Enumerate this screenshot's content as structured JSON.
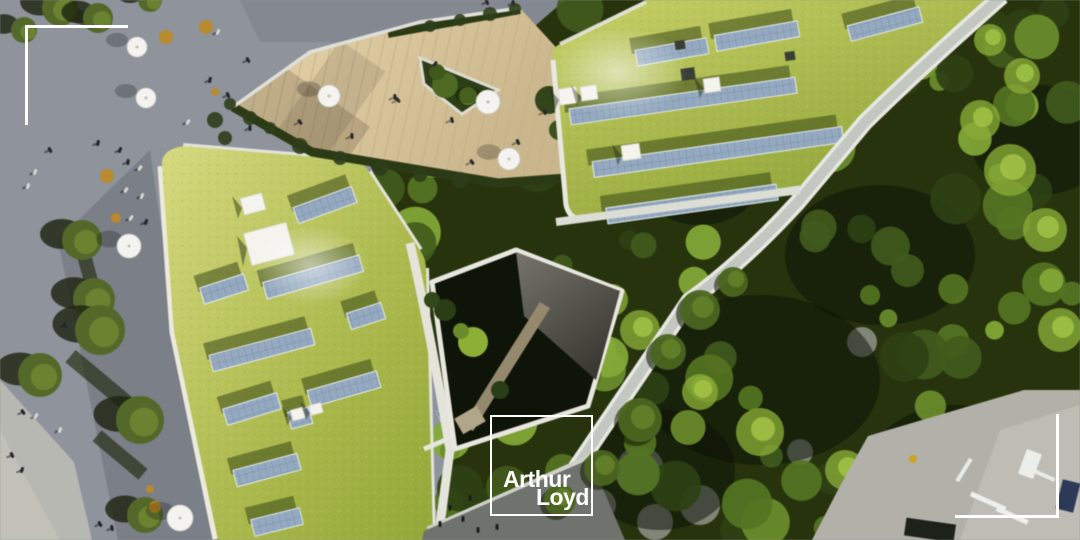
{
  "brand": {
    "name": "Arthur Loyd",
    "logo_line1": "Arthur",
    "logo_line2": "Loyd"
  },
  "scene": {
    "type": "aerial architectural render",
    "features": [
      "green roofs with solar panels",
      "wooden roof terrace with umbrellas",
      "public plaza with trees and people",
      "sunken courtyard garden",
      "dense tree canopy",
      "street with cars"
    ]
  },
  "palette": {
    "accent_white": "#ffffff",
    "plaza_gray": "#8e939b",
    "grass_light": "#d6da85",
    "grass_dark": "#8fa23c",
    "panel_blue": "#96aabf",
    "canopy_dark": "#27330f",
    "deck_wood": "#dccb9f"
  }
}
